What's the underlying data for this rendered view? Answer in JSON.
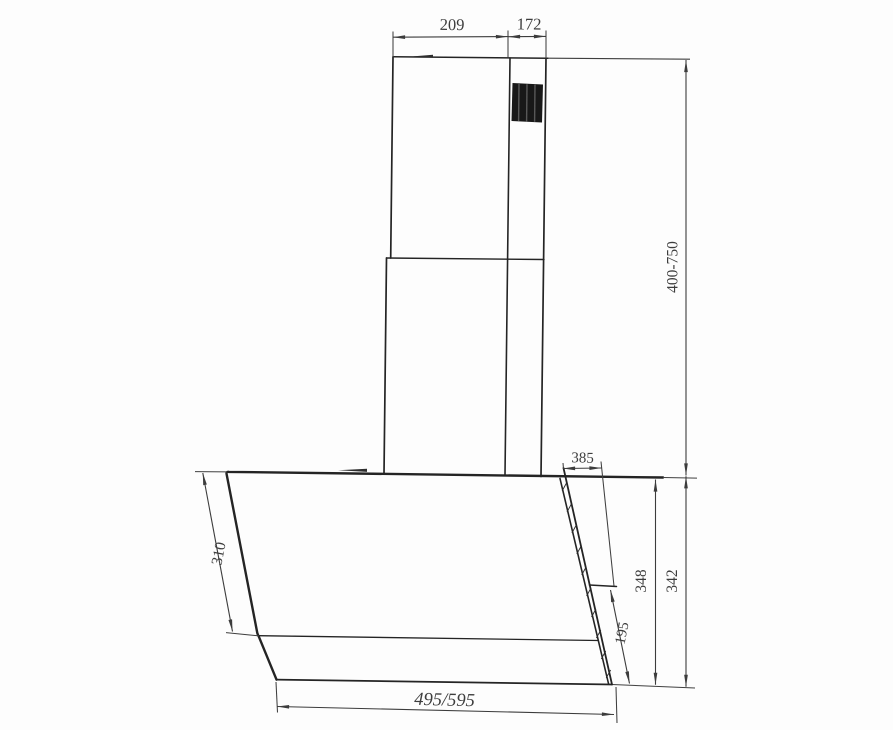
{
  "drawing": {
    "kind": "cooker-hood-dimension-drawing",
    "labels": {
      "chimney_top_width": "209",
      "chimney_top_offset": "172",
      "chimney_height_range": "400-750",
      "hood_top_depth": "385",
      "hood_back_height_inner": "348",
      "hood_back_height_outer": "342",
      "hood_lower_back_height": "195",
      "glass_panel_length": "310",
      "hood_width": "495/595"
    }
  }
}
